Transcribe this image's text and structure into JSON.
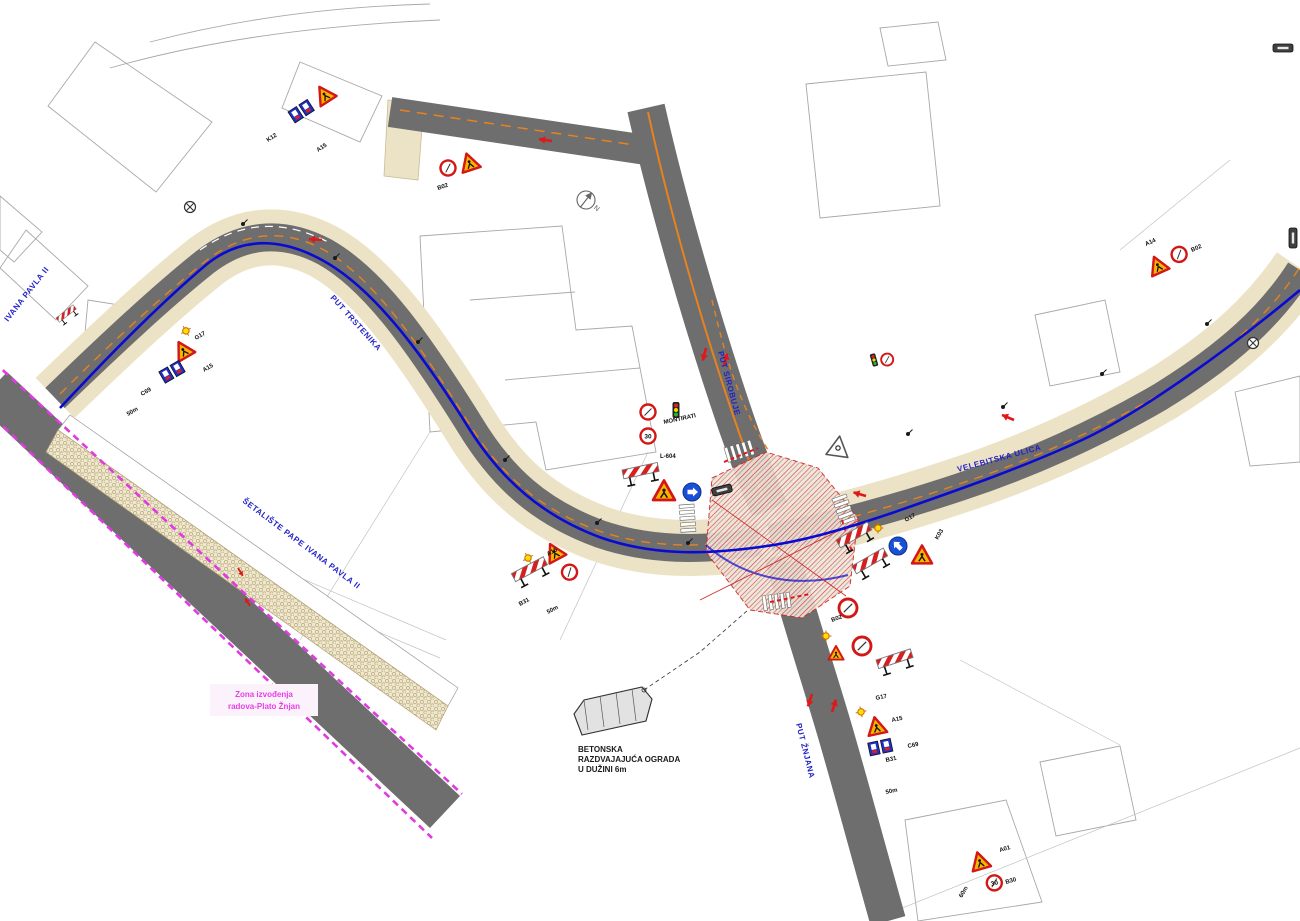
{
  "labels": {
    "zone_line1": "Zona izvođenja",
    "zone_line2": "radova-Plato Žnjan",
    "note_line1": "BETONSKA",
    "note_line2": "RAZDVAJAJUĆA OGRADA",
    "note_line3": "U DUŽINI 6m",
    "north_symbol": "N"
  },
  "streets": {
    "west": "PUT TRSTENIKA",
    "north": "PUT SIROBUJE",
    "east": "VELEBITSKA ULICA",
    "south": "PUT ŽNJANA",
    "promenade": "ŠETALIŠTE PAPE IVANA PAVLA II",
    "left_edge": "IVANA PAVLA II"
  },
  "sign_codes": {
    "g17": "G17",
    "a15": "A15",
    "a01": "A01",
    "a14": "A14",
    "c69": "C69",
    "b31": "B31",
    "b02": "B02",
    "b30": "B30",
    "k12": "K12",
    "k03": "K03",
    "l604": "L-604",
    "montirati": "MONTIRATI",
    "dist50": "50m",
    "dist60": "60m",
    "speed30": "30"
  },
  "colors": {
    "road": "#6e6e6e",
    "sidewalk": "#ece3c6",
    "route_blue": "#0a0ad0",
    "work_zone_magenta": "#e23ae2",
    "arrow_red": "#e01818",
    "centerline_orange": "#e8821e",
    "hatch_red": "#cc2a2a"
  }
}
